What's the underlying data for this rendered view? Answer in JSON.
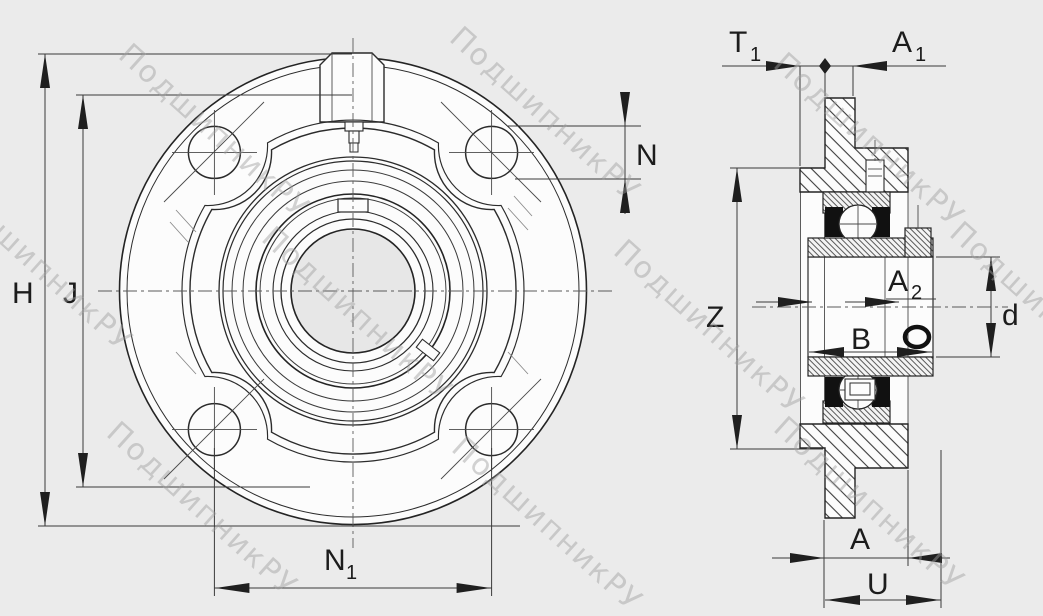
{
  "drawing": {
    "views": {
      "front_view": "flanged cartridge bearing unit, front",
      "side_view": "flanged cartridge bearing unit, section"
    },
    "colors": {
      "background": "#ebebeb",
      "part_fill": "#fcfcfc",
      "bore_fill": "#e7e7e7",
      "line": "#2b2b2b",
      "dimension_line": "#3a3a3a",
      "seal": "#111111",
      "watermark": "#9f9f9f"
    }
  },
  "labels": {
    "H": "H",
    "J": "J",
    "N": "N",
    "N1_main": "N",
    "N1_sub": "1",
    "T1_main": "T",
    "T1_sub": "1",
    "A1_main": "A",
    "A1_sub": "1",
    "Z": "Z",
    "A2_main": "A",
    "A2_sub": "2",
    "B": "B",
    "d": "d",
    "A": "A",
    "U": "U"
  },
  "watermark": {
    "text": "ПодшипникРУ"
  }
}
